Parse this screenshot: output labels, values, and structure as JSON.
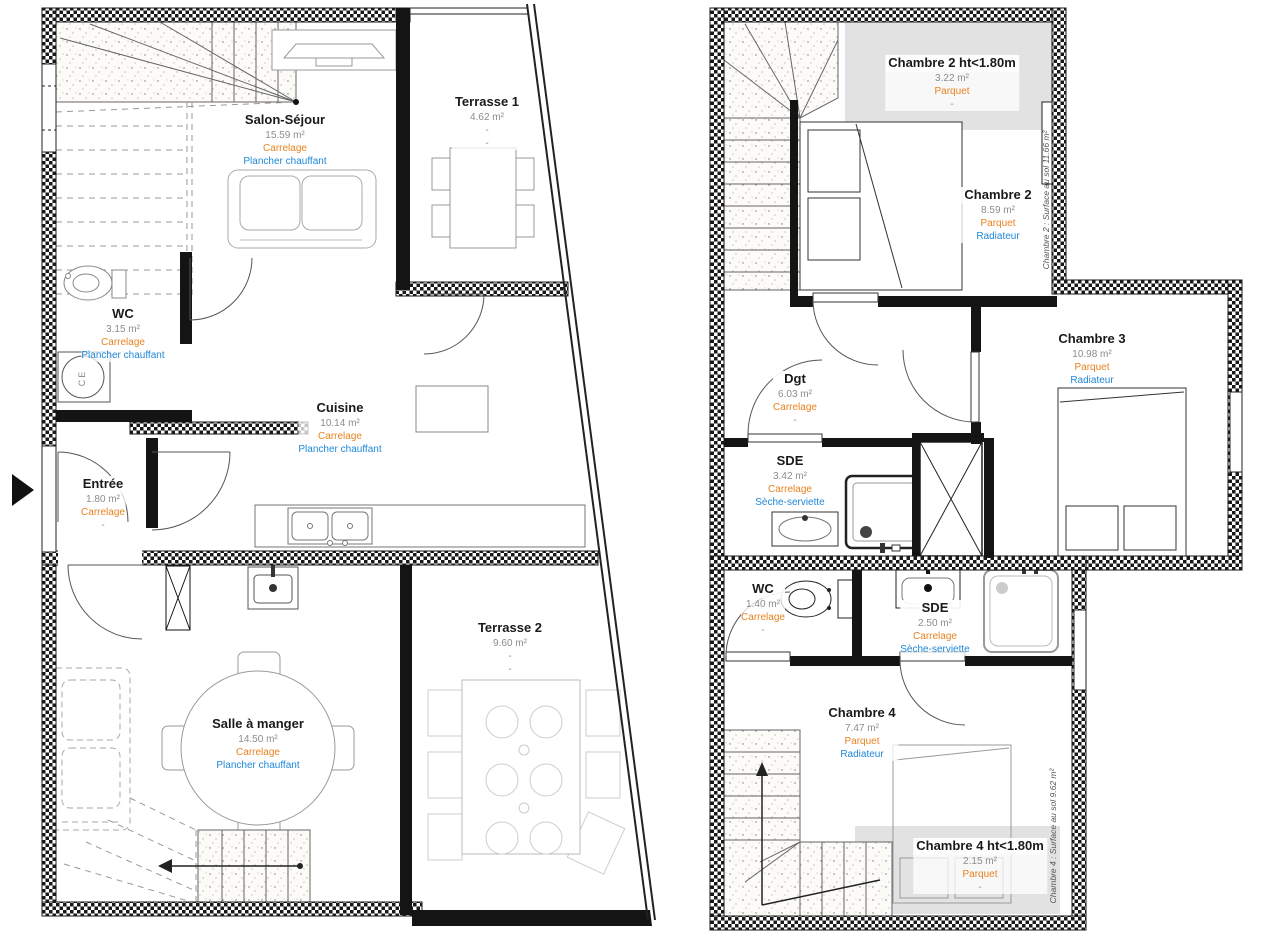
{
  "document_type": "floor-plan",
  "colors": {
    "room_name": "#1a1a1a",
    "area_text": "#8c8c8c",
    "floor_material_text": "#e8821e",
    "heating_text": "#1e88d8",
    "wall": "#141414",
    "low_ceiling_zone": "#e2e2e2"
  },
  "ground_floor": {
    "rooms": [
      {
        "label": "Salon-Séjour",
        "area": "15.59 m²",
        "floor": "Carrelage",
        "heating": "Plancher chauffant"
      },
      {
        "label": "Terrasse 1",
        "area": "4.62 m²",
        "floor": "-",
        "heating": "-"
      },
      {
        "label": "WC",
        "area": "3.15 m²",
        "floor": "Carrelage",
        "heating": "Plancher chauffant"
      },
      {
        "label": "Cuisine",
        "area": "10.14 m²",
        "floor": "Carrelage",
        "heating": "Plancher chauffant"
      },
      {
        "label": "Entrée",
        "area": "1.80 m²",
        "floor": "Carrelage",
        "heating": "-"
      },
      {
        "label": "Salle à manger",
        "area": "14.50 m²",
        "floor": "Carrelage",
        "heating": "Plancher chauffant"
      },
      {
        "label": "Terrasse 2",
        "area": "9.60 m²",
        "floor": "-",
        "heating": "-"
      }
    ],
    "annotations": {
      "water_heater": "CE"
    }
  },
  "upper_floor": {
    "rooms": [
      {
        "label": "Chambre 2 ht<1.80m",
        "area": "3.22 m²",
        "floor": "Parquet",
        "heating": "-"
      },
      {
        "label": "Chambre 2",
        "area": "8.59 m²",
        "floor": "Parquet",
        "heating": "Radiateur"
      },
      {
        "label": "Chambre 3",
        "area": "10.98 m²",
        "floor": "Parquet",
        "heating": "Radiateur"
      },
      {
        "label": "Dgt",
        "area": "6.03 m²",
        "floor": "Carrelage",
        "heating": "-"
      },
      {
        "label": "SDE",
        "area": "3.42 m²",
        "floor": "Carrelage",
        "heating": "Sèche-serviette"
      },
      {
        "label": "WC",
        "area": "1.40 m²",
        "floor": "Carrelage",
        "heating": "-"
      },
      {
        "label": "SDE",
        "area": "2.50 m²",
        "floor": "Carrelage",
        "heating": "Sèche-serviette"
      },
      {
        "label": "Chambre 4",
        "area": "7.47 m²",
        "floor": "Parquet",
        "heating": "Radiateur"
      },
      {
        "label": "Chambre 4 ht<1.80m",
        "area": "2.15 m²",
        "floor": "Parquet",
        "heating": "-"
      }
    ],
    "wall_notes": [
      {
        "text": "Chambre 2 : Surface au sol 11.66 m²"
      },
      {
        "text": "Chambre 4 : Surface au sol 9.62 m²"
      }
    ]
  }
}
